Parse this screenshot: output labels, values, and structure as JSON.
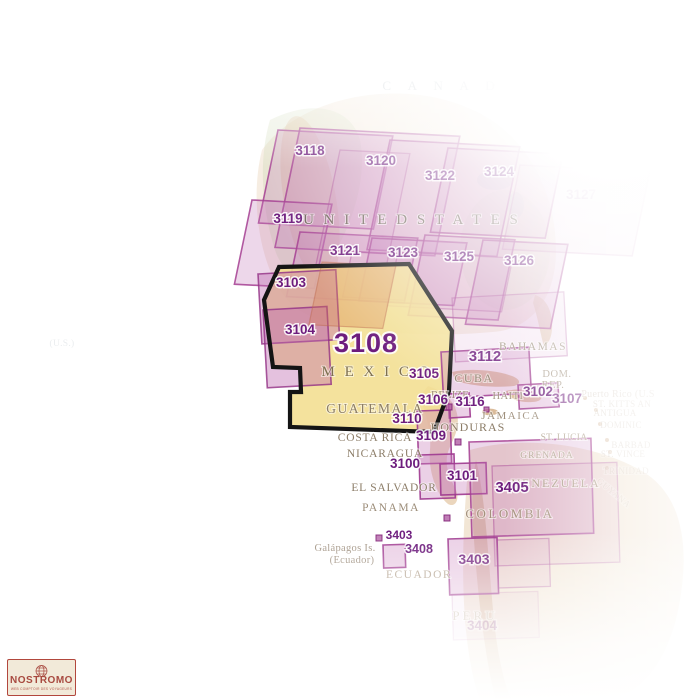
{
  "highlight": {
    "number": "3108",
    "country": "MEXICO",
    "number_x": 366,
    "number_y": 352,
    "polygon": [
      [
        279,
        267
      ],
      [
        264,
        300
      ],
      [
        273,
        367
      ],
      [
        300,
        368
      ],
      [
        301,
        392
      ],
      [
        290,
        392
      ],
      [
        290,
        427
      ],
      [
        434,
        432
      ],
      [
        449,
        391
      ],
      [
        452,
        331
      ],
      [
        409,
        264
      ]
    ]
  },
  "colors": {
    "highlight_fill": "#f3df92",
    "highlight_border": "#141414",
    "box_fill": "#c579b8",
    "box_border": "#a43e92",
    "chart_number": "#6d1c7d",
    "country_text": "#8c7d68",
    "canada_text": "#b5bfc6",
    "logo_red": "#a8493f"
  },
  "chart_boxes": [
    {
      "id": "3118",
      "p": "n",
      "x": 278,
      "y": 130,
      "w": 115,
      "h": 95,
      "v": "n"
    },
    {
      "id": "3120",
      "p": "n",
      "x": 300,
      "y": 128,
      "w": 160,
      "h": 122,
      "v": "n"
    },
    {
      "id": "3122",
      "p": "n",
      "x": 390,
      "y": 140,
      "w": 130,
      "h": 112,
      "v": "n"
    },
    {
      "id": "3124",
      "p": "n",
      "x": 448,
      "y": 148,
      "w": 115,
      "h": 86,
      "v": "n"
    },
    {
      "id": "3127",
      "p": "n",
      "x": 520,
      "y": 165,
      "w": 130,
      "h": 86,
      "v": "f"
    },
    {
      "id": "3119",
      "p": "n",
      "x": 252,
      "y": 200,
      "w": 80,
      "h": 86,
      "v": "n"
    },
    {
      "id": "3121",
      "p": "n",
      "x": 300,
      "y": 232,
      "w": 118,
      "h": 66,
      "v": "n"
    },
    {
      "id": "3123",
      "p": "n",
      "x": 372,
      "y": 238,
      "w": 95,
      "h": 64,
      "v": "n"
    },
    {
      "id": "3125",
      "p": "n",
      "x": 425,
      "y": 235,
      "w": 90,
      "h": 82,
      "v": "n"
    },
    {
      "id": "3126",
      "p": "n",
      "x": 483,
      "y": 240,
      "w": 85,
      "h": 86,
      "v": "n"
    },
    {
      "id": "unlabeled-a",
      "p": "n",
      "x": 340,
      "y": 150,
      "w": 70,
      "h": 118,
      "v": "x"
    },
    {
      "id": "unlabeled-b",
      "p": "n",
      "x": 352,
      "y": 252,
      "w": 62,
      "h": 46,
      "v": "x"
    },
    {
      "id": "unlabeled-c",
      "p": "n",
      "x": 398,
      "y": 252,
      "w": 115,
      "h": 55,
      "v": "x"
    },
    {
      "id": "unlabeled-gulf",
      "p": "m",
      "x": 452,
      "y": 298,
      "w": 112,
      "h": 64,
      "v": "x"
    },
    {
      "id": "3103",
      "p": "m",
      "x": 258,
      "y": 274,
      "w": 78,
      "h": 70,
      "v": "o"
    },
    {
      "id": "3104",
      "p": "m",
      "x": 263,
      "y": 310,
      "w": 64,
      "h": 78,
      "v": "o"
    },
    {
      "id": "unlabeled-baja",
      "p": "n",
      "x": 322,
      "y": 262,
      "w": 74,
      "h": 64,
      "v": "sal"
    },
    {
      "id": "3112",
      "p": "m",
      "x": 441,
      "y": 352,
      "w": 88,
      "h": 46,
      "v": "s"
    },
    {
      "id": "3102",
      "p": "m",
      "x": 518,
      "y": 385,
      "w": 40,
      "h": 24,
      "v": "s"
    },
    {
      "id": "3116",
      "p": "m",
      "x": 448,
      "y": 394,
      "w": 21,
      "h": 24,
      "v": "s"
    },
    {
      "id": "3109",
      "p": "s",
      "x": 417,
      "y": 411,
      "w": 33,
      "h": 53,
      "v": "s"
    },
    {
      "id": "3100",
      "p": "s",
      "x": 419,
      "y": 455,
      "w": 35,
      "h": 44,
      "v": "s"
    },
    {
      "id": "3101",
      "p": "s",
      "x": 440,
      "y": 464,
      "w": 46,
      "h": 31,
      "v": "s"
    },
    {
      "id": "3405",
      "p": "s",
      "x": 469,
      "y": 442,
      "w": 122,
      "h": 95,
      "v": "n"
    },
    {
      "id": "unlabeled-d",
      "p": "s",
      "x": 492,
      "y": 466,
      "w": 125,
      "h": 100,
      "v": "x"
    },
    {
      "id": "3403",
      "p": "s",
      "x": 448,
      "y": 539,
      "w": 49,
      "h": 56,
      "v": "s"
    },
    {
      "id": "unlabeled-e",
      "p": "s",
      "x": 497,
      "y": 540,
      "w": 52,
      "h": 48,
      "v": "x"
    },
    {
      "id": "3408",
      "p": "s",
      "x": 383,
      "y": 545,
      "w": 22,
      "h": 23,
      "v": "s"
    },
    {
      "id": "3404",
      "p": "s",
      "x": 452,
      "y": 594,
      "w": 86,
      "h": 46,
      "v": "xx"
    }
  ],
  "chart_markers": [
    [
      446,
      404,
      6
    ],
    [
      484,
      407,
      5
    ],
    [
      455,
      439,
      6
    ],
    [
      444,
      515,
      6
    ],
    [
      376,
      535,
      6
    ]
  ],
  "chart_labels": [
    {
      "id": "3118",
      "x": 310,
      "y": 155
    },
    {
      "id": "3120",
      "x": 381,
      "y": 165
    },
    {
      "id": "3122",
      "x": 440,
      "y": 180
    },
    {
      "id": "3124",
      "x": 499,
      "y": 176
    },
    {
      "id": "3127",
      "x": 581,
      "y": 199,
      "op": 0.55
    },
    {
      "id": "3119",
      "x": 288,
      "y": 223
    },
    {
      "id": "3121",
      "x": 345,
      "y": 255
    },
    {
      "id": "3123",
      "x": 403,
      "y": 257
    },
    {
      "id": "3125",
      "x": 459,
      "y": 261
    },
    {
      "id": "3126",
      "x": 519,
      "y": 265
    },
    {
      "id": "3103",
      "x": 291,
      "y": 287
    },
    {
      "id": "3104",
      "x": 300,
      "y": 334
    },
    {
      "id": "3105",
      "x": 424,
      "y": 378
    },
    {
      "id": "3112",
      "x": 485,
      "y": 361,
      "size": 15
    },
    {
      "id": "3102",
      "x": 538,
      "y": 396
    },
    {
      "id": "3107",
      "x": 567,
      "y": 403,
      "op": 0.8
    },
    {
      "id": "3106",
      "x": 433,
      "y": 404
    },
    {
      "id": "3116",
      "x": 470,
      "y": 406
    },
    {
      "id": "3110",
      "x": 407,
      "y": 423
    },
    {
      "id": "3109",
      "x": 431,
      "y": 440
    },
    {
      "id": "3100",
      "x": 405,
      "y": 468
    },
    {
      "id": "3101",
      "x": 462,
      "y": 480
    },
    {
      "id": "3405",
      "x": 512,
      "y": 492,
      "size": 15
    },
    {
      "id": "3403",
      "x": 399,
      "y": 539,
      "size": 12
    },
    {
      "id": "3408",
      "x": 419,
      "y": 553,
      "size": 12.5
    },
    {
      "id": "3403",
      "x": 474,
      "y": 564,
      "size": 14,
      "op": 0.9
    },
    {
      "id": "3404",
      "x": 482,
      "y": 630,
      "op": 0.4
    }
  ],
  "country_labels": [
    {
      "t": "C A N A D A",
      "x": 455,
      "y": 90,
      "s": 13,
      "ls": 7,
      "c": "#b5bfc6",
      "op": 0.95
    },
    {
      "t": "U N I T E D   S T A T E S",
      "x": 412,
      "y": 224,
      "s": 15,
      "ls": 3,
      "c": "#6e6358"
    },
    {
      "t": "M E X I C O",
      "x": 377,
      "y": 376,
      "s": 15,
      "ls": 3,
      "c": "#7e7050"
    },
    {
      "t": "GUATEMALA",
      "x": 375,
      "y": 413,
      "s": 13.5,
      "ls": 1.5,
      "c": "#8c7d64"
    },
    {
      "t": "BAHAMAS",
      "x": 533,
      "y": 350,
      "s": 11.5,
      "ls": 1.5,
      "c": "#9c8e7b"
    },
    {
      "t": "CUBA",
      "x": 474,
      "y": 382,
      "s": 12,
      "ls": 1.5,
      "c": "#8c7d68"
    },
    {
      "t": "HAITI",
      "x": 508,
      "y": 399,
      "s": 10.5,
      "ls": 0.5,
      "c": "#9c8d79"
    },
    {
      "t": "DOM.",
      "x": 557,
      "y": 377,
      "s": 10.5,
      "ls": 0.5,
      "c": "#a89a88"
    },
    {
      "t": "REP.",
      "x": 553,
      "y": 388,
      "s": 10.5,
      "ls": 0.5,
      "c": "#a89a88"
    },
    {
      "t": "BELIZE",
      "x": 450,
      "y": 398,
      "s": 10.5,
      "ls": 0.3,
      "c": "#9c8d79"
    },
    {
      "t": "JAMAICA",
      "x": 511,
      "y": 419,
      "s": 11,
      "ls": 1.5,
      "c": "#9c8d79"
    },
    {
      "t": "HONDURAS",
      "x": 468,
      "y": 431,
      "s": 12,
      "ls": 1,
      "c": "#8c7d68"
    },
    {
      "t": "COSTA RICA",
      "x": 375,
      "y": 441,
      "s": 11.5,
      "ls": 0.8,
      "c": "#8c7d68"
    },
    {
      "t": "NICARAGUA",
      "x": 385,
      "y": 457,
      "s": 11.5,
      "ls": 0.8,
      "c": "#8c7d68"
    },
    {
      "t": "EL SALVADOR",
      "x": 394,
      "y": 491,
      "s": 11.5,
      "ls": 0.8,
      "c": "#8c7d68"
    },
    {
      "t": "PANAMA",
      "x": 391,
      "y": 511,
      "s": 11.5,
      "ls": 1.5,
      "c": "#9c8d79"
    },
    {
      "t": "VENEZUELA",
      "x": 556,
      "y": 487,
      "s": 12,
      "ls": 2,
      "c": "#ab9a85"
    },
    {
      "t": "COLOMBIA",
      "x": 510,
      "y": 518,
      "s": 13,
      "ls": 2.5,
      "c": "#a4917c"
    },
    {
      "t": "ST. LUCIA",
      "x": 564,
      "y": 440,
      "s": 9.5,
      "ls": 0.3,
      "c": "#b5a794"
    },
    {
      "t": "GRENADA",
      "x": 547,
      "y": 458,
      "s": 9.5,
      "ls": 1,
      "c": "#b5a794"
    },
    {
      "t": "Galápagos Is.",
      "x": 345,
      "y": 551,
      "s": 10.5,
      "ls": 0.3,
      "c": "#a29484"
    },
    {
      "t": "(Ecuador)",
      "x": 352,
      "y": 563,
      "s": 10.5,
      "ls": 0.3,
      "c": "#a29484"
    },
    {
      "t": "ECUADOR",
      "x": 419,
      "y": 578,
      "s": 11.5,
      "ls": 1.5,
      "c": "#b4a390"
    },
    {
      "t": "PERU",
      "x": 475,
      "y": 620,
      "s": 13,
      "ls": 3,
      "c": "#d0c3b4"
    },
    {
      "t": "Puerto Rico (U.S",
      "x": 618,
      "y": 397,
      "s": 10,
      "ls": 0.3,
      "c": "#c9bcae",
      "op": 0.6
    },
    {
      "t": "ST. KITTS AN",
      "x": 622,
      "y": 407,
      "s": 9,
      "ls": 0.3,
      "c": "#c9bcae",
      "op": 0.55
    },
    {
      "t": "ANTIGUA",
      "x": 615,
      "y": 416,
      "s": 9,
      "ls": 0.3,
      "c": "#c9bcae",
      "op": 0.55
    },
    {
      "t": "DOMINIC",
      "x": 621,
      "y": 428,
      "s": 9,
      "ls": 0.3,
      "c": "#c9bcae",
      "op": 0.5
    },
    {
      "t": "BARBAD",
      "x": 631,
      "y": 448,
      "s": 9,
      "ls": 0.3,
      "c": "#c9bcae",
      "op": 0.5
    },
    {
      "t": "ST. VINCE",
      "x": 623,
      "y": 457,
      "s": 9,
      "ls": 0.3,
      "c": "#c9bcae",
      "op": 0.5
    },
    {
      "t": "TRINIDAD",
      "x": 626,
      "y": 474,
      "s": 9,
      "ls": 0.3,
      "c": "#c9bcae",
      "op": 0.45
    },
    {
      "t": "GUYANA",
      "x": 612,
      "y": 495,
      "s": 9,
      "ls": 0.5,
      "c": "#c9bcae",
      "op": 0.45,
      "rot": 40
    },
    {
      "t": "(U.S.)",
      "x": 62,
      "y": 346,
      "s": 9.5,
      "ls": 0.3,
      "c": "#dde2e5",
      "op": 0.6
    }
  ],
  "logo": {
    "brand": "NOSTROMO",
    "tagline": "WEB COMPTOIR DES VOYAGEURS"
  }
}
